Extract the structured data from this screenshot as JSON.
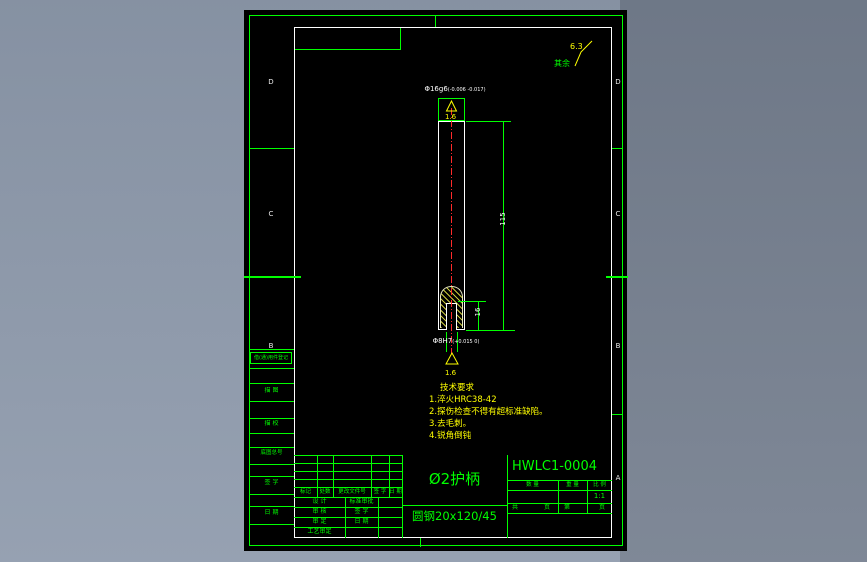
{
  "zones": {
    "left": [
      "D",
      "C",
      "B"
    ],
    "right": [
      "D",
      "C",
      "B",
      "A"
    ]
  },
  "annotations": {
    "default_roughness_prefix": "其余",
    "default_roughness_value": "6.3",
    "dim_diameter_main": "Φ16g6",
    "dim_diameter_tol": "(-0.006 -0.017)",
    "roughness_top": "1.6",
    "dim_length": "115",
    "dim_hole_depth": "16",
    "dim_hole_main": "Φ8H7",
    "dim_hole_tol": "(+0.015 0)",
    "roughness_hole": "1.6"
  },
  "tech_requirements": {
    "title": "技术要求",
    "items": [
      "1.淬火HRC38-42",
      "2.探伤检查不得有超标准缺陷。",
      "3.去毛刺。",
      "4.锐角倒钝"
    ]
  },
  "margin_blocks": {
    "register": "借(通)用件登记",
    "items": [
      "描 图",
      "描 校",
      "底图总号",
      "签 字",
      "日 期"
    ]
  },
  "title_block": {
    "part_name": "Ø2护柄",
    "drawing_number": "HWLC1-0004",
    "material": "圆钢20x120/45",
    "scale_value": "1:1",
    "qty_headers": [
      "数 量",
      "重 量",
      "比 例"
    ],
    "sheet_row": [
      "共",
      "页",
      "第",
      "页"
    ],
    "revision_headers": [
      "标记",
      "处数",
      "更改文件号",
      "签 字",
      "日 期"
    ],
    "approval_rows": [
      {
        "label": "设 计",
        "mid": "标准审批"
      },
      {
        "label": "审 核",
        "mid": "签 字"
      },
      {
        "label": "审 定",
        "mid": "日 期"
      },
      {
        "label": "工艺审定",
        "mid": ""
      }
    ]
  },
  "colors": {
    "line_green": "#00ff00",
    "text_yellow": "#ffff00",
    "text_white": "#ffffff",
    "centerline_red": "#ff2a2a",
    "canvas_black": "#000000"
  }
}
